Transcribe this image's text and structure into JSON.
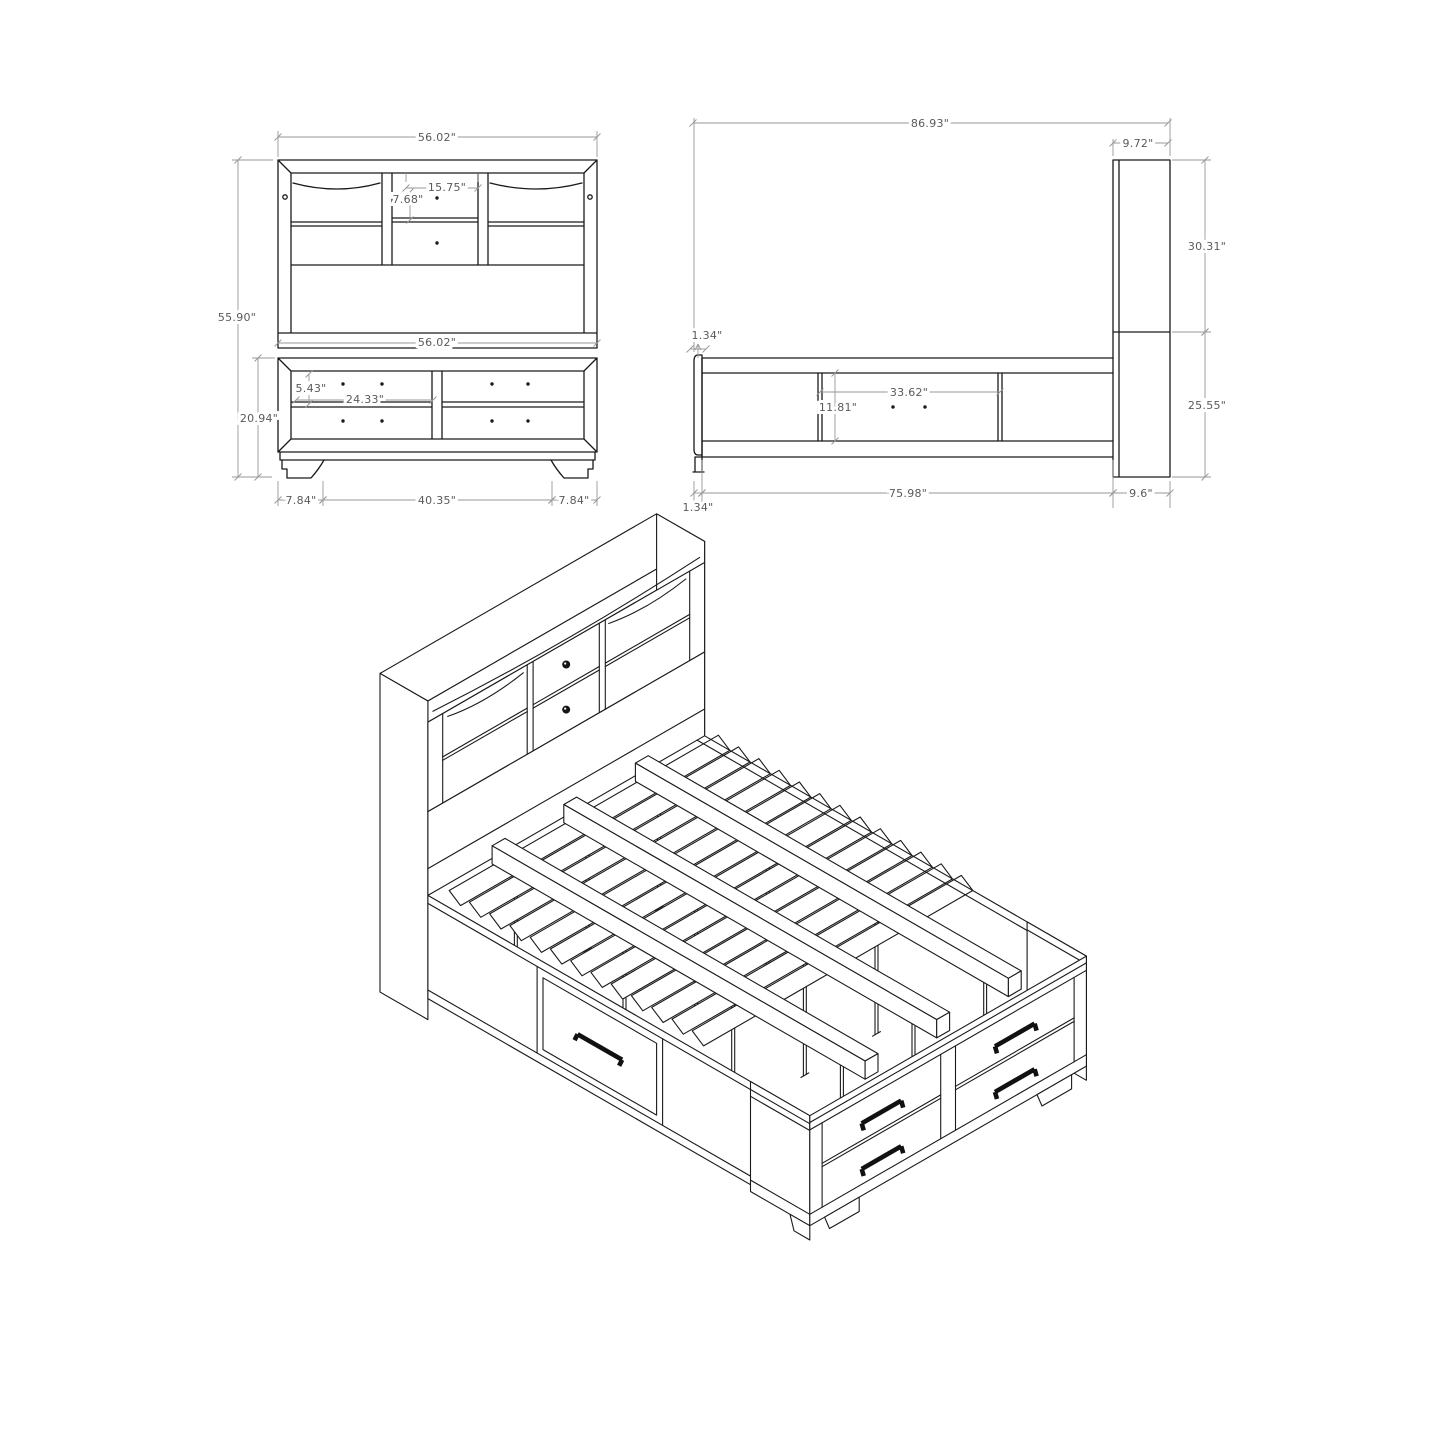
{
  "page": {
    "background": "#ffffff",
    "line_color": "#1a1a1a",
    "dim_line_color": "#979797",
    "dim_text_color": "#5a5a5a",
    "subject": "storage bed with bookcase headboard — dimensioned assembly drawing"
  },
  "views": {
    "front": {
      "name": "front-elevation",
      "dims": {
        "overall_width": "56.02\"",
        "hutch_center_width": "15.75\"",
        "hutch_drawer_height": "7.68\"",
        "overall_height": "55.90\"",
        "rail_width": "56.02\"",
        "drawer_face_height": "5.43\"",
        "drawer_face_width": "24.33\"",
        "storage_unit_height": "20.94\"",
        "left_foot_offset": "7.84\"",
        "foot_span": "40.35\"",
        "right_foot_offset": "7.84\""
      }
    },
    "side": {
      "name": "side-elevation",
      "dims": {
        "overall_length": "86.93\"",
        "headboard_depth": "9.72\"",
        "headboard_upper_height": "30.31\"",
        "headboard_lower_height": "25.55\"",
        "footboard_top_thickness": "1.34\"",
        "side_drawer_width": "33.62\"",
        "side_drawer_height": "11.81\"",
        "rail_length": "75.98\"",
        "headboard_base_depth": "9.6\"",
        "footboard_bottom_thickness": "1.34\""
      }
    },
    "isometric": {
      "name": "isometric-assembly"
    }
  }
}
